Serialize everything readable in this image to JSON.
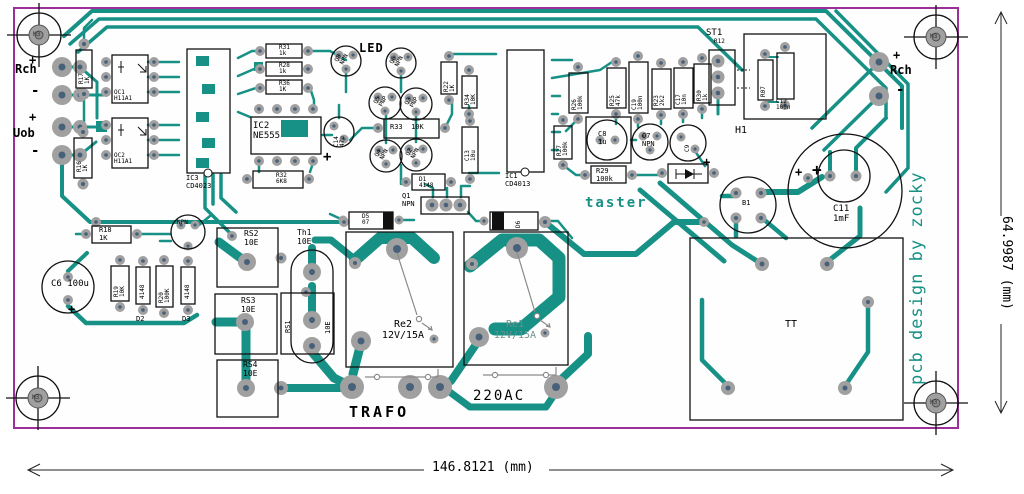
{
  "io": {
    "left_top_plus": "+",
    "left_top": "Rch",
    "left_top_minus": "-",
    "left_bot_plus": "+",
    "left_bot": "Uob",
    "left_bot_minus": "-",
    "right_plus": "+",
    "right": "Rch",
    "right_minus": "-"
  },
  "hole": "M3",
  "parts": {
    "r17": "R17\n1K",
    "oc1": "OC1\nH11A1",
    "oc2": "OC2\nH11A1",
    "r16": "R16\n1K",
    "ic3": "IC3\nCD4023",
    "r31": "R31\n1k",
    "r28": "R28\n1k",
    "r36": "R36\n1K",
    "ic2": "IC2\nNE555",
    "r32": "R32\n6K8",
    "c14": "C14\n47u",
    "q8": "Q8\nNPN",
    "q6": "Q6\nNPN",
    "q5": "Q5\nPNP",
    "q3": "Q3\nPNP",
    "q4": "Q4\nNPN",
    "q2": "Q2\nNPN",
    "r33": "R33  10K",
    "r22": "R22\n1K",
    "r34": "R34\n10K",
    "c13": "C13\n10u",
    "d1": "D1\n4148",
    "ic1": "IC1\nCD4013",
    "q1": "Q1\nNPN",
    "d5": "D5\n07",
    "d6": "D6",
    "re2": "Re2\n12V/15A",
    "re1": "Re1\n12V/15A",
    "r18": "R18\n1K",
    "q9": "NPN",
    "c6": "C6 100u",
    "r19": "R19\n10K",
    "d2_val": "4148",
    "r20": "R20\n100K",
    "d3_val": "4148",
    "d2": "D2",
    "d3": "D3",
    "rs2": "RS2\n10E",
    "rs3": "RS3\n10E",
    "rs4": "RS4\n10E",
    "rs1": "RS1",
    "rs1_val": "10E",
    "th1": "Th1\n10E",
    "r26": "R26\n100k",
    "r25": "R25\n47k",
    "c19": "C19\n100n",
    "r23": "R23\n2k2",
    "c17": "C17\n10n",
    "r30": "R30\n1k",
    "r27": "R27\n100k",
    "c8": "C8\n1u",
    "q7": "Q7\nNPN",
    "c9": "C9",
    "r29": "R29\n100k",
    "st1": "ST1",
    "r12": "R12",
    "h1": "H1",
    "r07": "R07",
    "c12": "C12\n100n",
    "b1": "B1",
    "c11": "C11\n1mF",
    "tt": "TT"
  },
  "texts": {
    "led": "LED",
    "taster": "taster",
    "trafo": "TRAFO",
    "ac": "220AC",
    "credit": "pcb design by zocky",
    "plus": "+"
  },
  "dims": {
    "w": "146.8121 (mm)",
    "h": "64.9987 (mm)"
  },
  "colors": {
    "trace": "#179186",
    "board_outline": "#9b3198",
    "pad_outer": "#a0a0a0",
    "pad_inner": "#47617b",
    "silk": "#111111"
  }
}
